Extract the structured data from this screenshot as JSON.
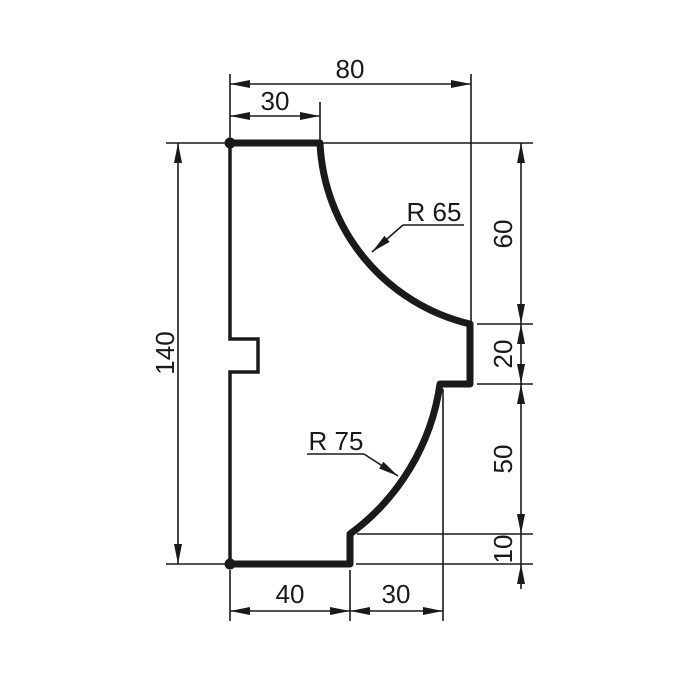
{
  "colors": {
    "line": "#1a1a1a",
    "background": "#ffffff"
  },
  "dims": {
    "total_width": "80",
    "top_flat_width": "30",
    "total_height": "140",
    "upper_right_height": "60",
    "middle_step_height": "20",
    "lower_right_height": "50",
    "bottom_step_height": "10",
    "bottom_flat_width": "40",
    "bottom_right_width": "30",
    "upper_radius": "R 65",
    "lower_radius": "R 75"
  }
}
